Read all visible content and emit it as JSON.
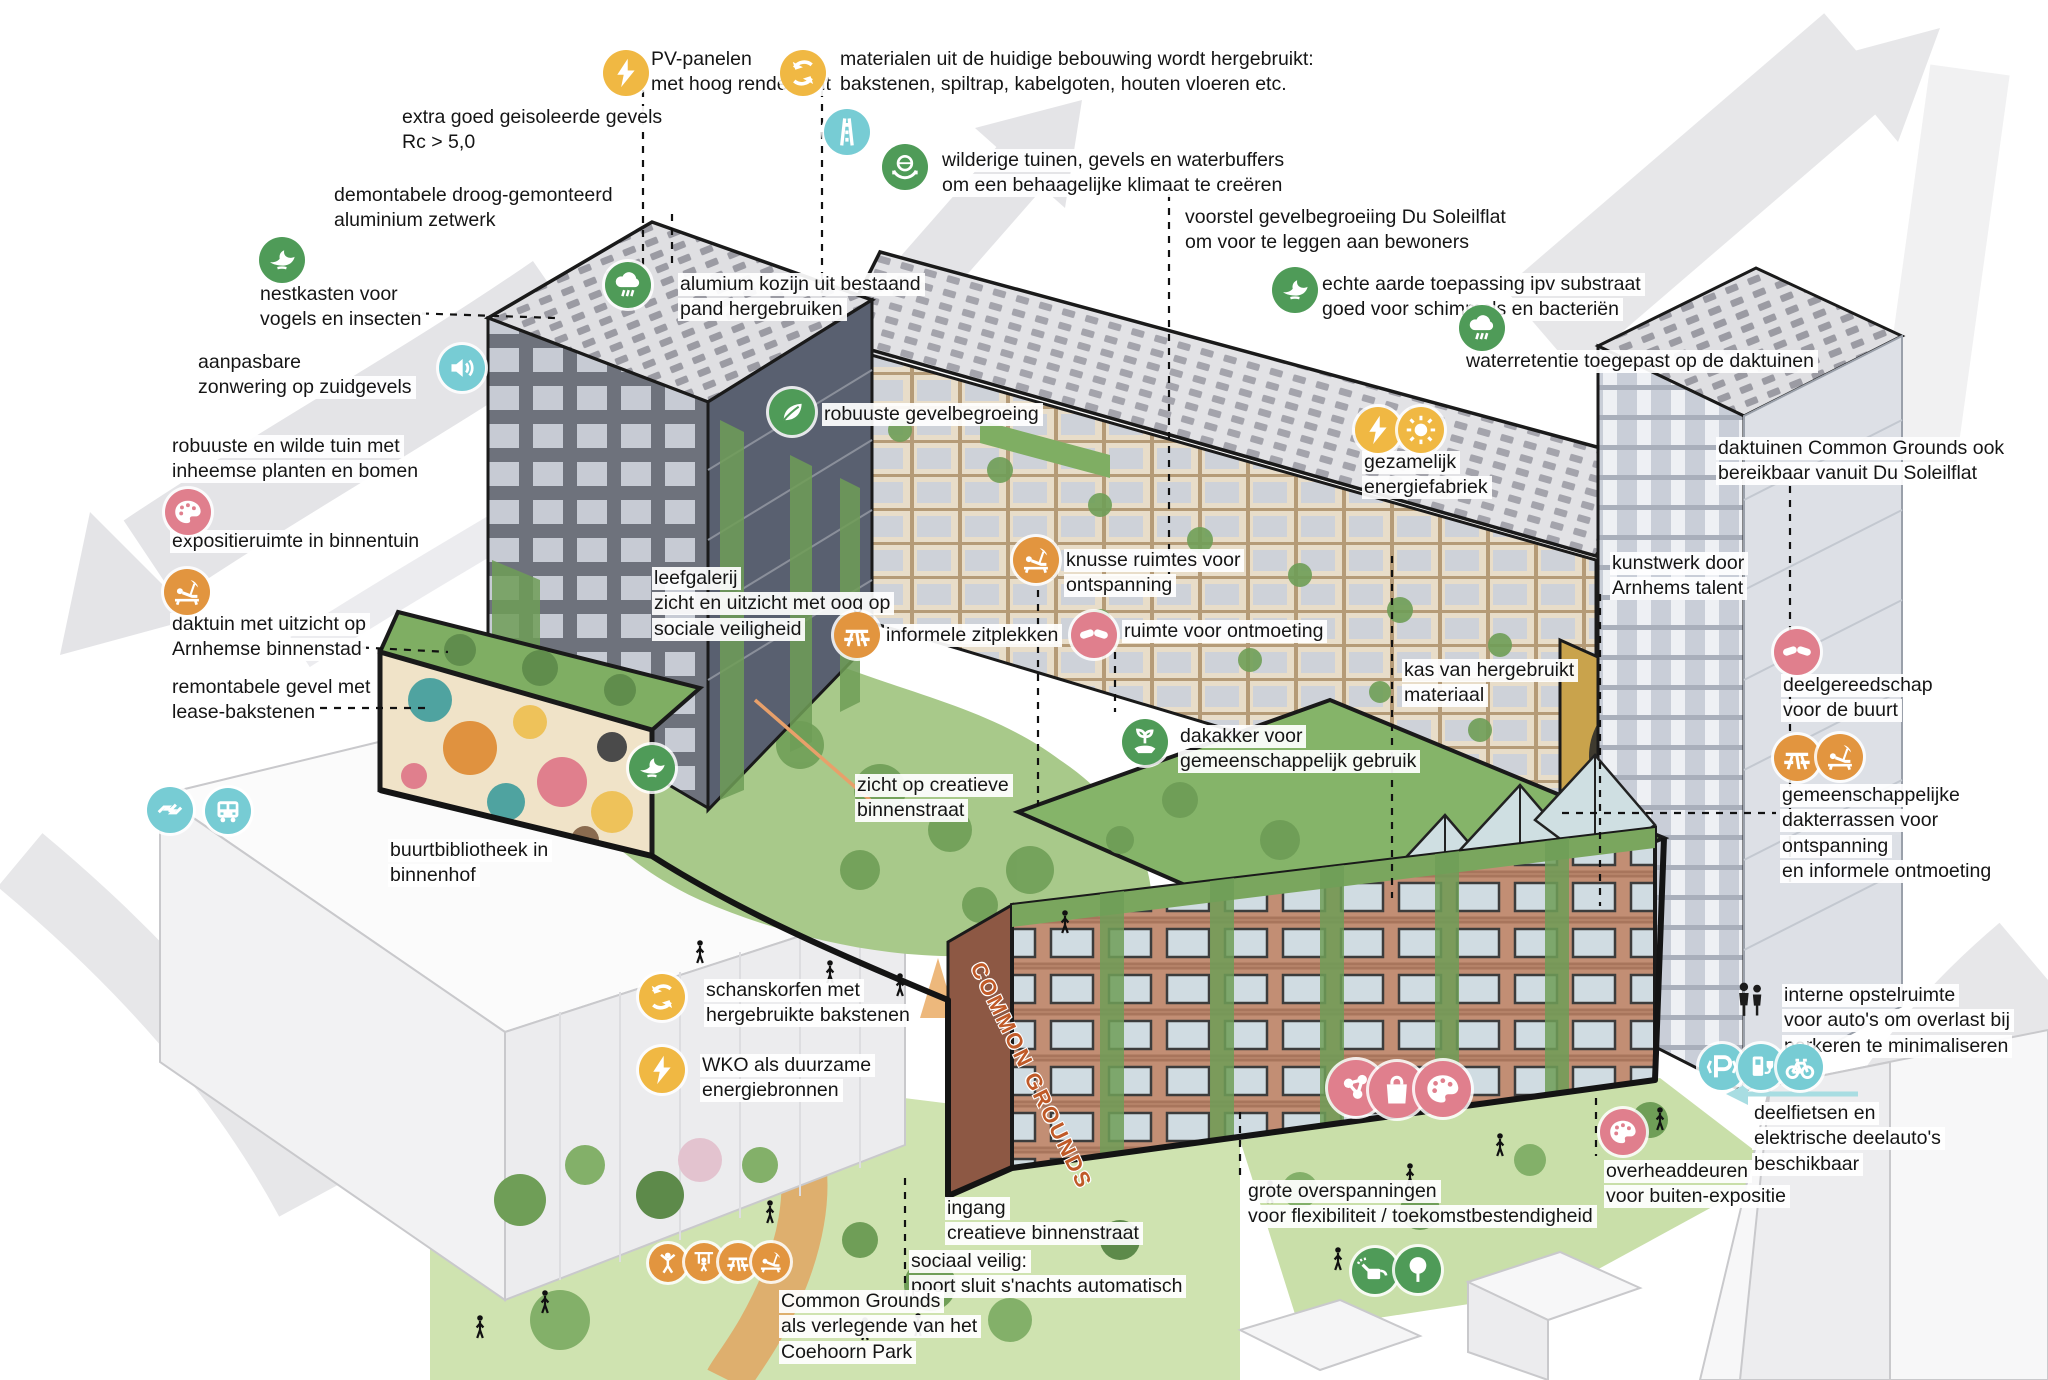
{
  "palette": {
    "yellow": "#f0b843",
    "teal": "#77ccd4",
    "green": "#4f9b58",
    "pink": "#e07f8d",
    "orange": "#e2953f",
    "plain": "none"
  },
  "sign": {
    "text": "COMMON GROUNDS"
  },
  "labels": [
    {
      "id": "pv-panelen",
      "x": 649,
      "y": 47,
      "text": "PV-panelen\nmet hoog rendement"
    },
    {
      "id": "extra-geisoleerd",
      "x": 400,
      "y": 105,
      "text": "extra goed geisoleerde gevels\nRc > 5,0"
    },
    {
      "id": "demontabele",
      "x": 332,
      "y": 183,
      "text": "demontabele droog-gemonteerd\naluminium zetwerk"
    },
    {
      "id": "materialen",
      "x": 838,
      "y": 47,
      "text": "materialen uit de huidige bebouwing wordt hergebruikt:\nbakstenen, spiltrap, kabelgoten, houten vloeren etc."
    },
    {
      "id": "wilderige-tuinen",
      "x": 940,
      "y": 148,
      "text": "wilderige tuinen, gevels en waterbuffers\nom een behaagelijke klimaat te creëren"
    },
    {
      "id": "nestkasten",
      "x": 258,
      "y": 282,
      "text": "nestkasten voor\nvogels en insecten"
    },
    {
      "id": "aanpasbare-zonwering",
      "x": 196,
      "y": 350,
      "text": "aanpasbare\nzonwering op zuidgevels"
    },
    {
      "id": "voorstel-gevelbegroeiing",
      "x": 1183,
      "y": 205,
      "text": "voorstel gevelbegroeiing Du Soleilflat\nom voor te leggen aan bewoners"
    },
    {
      "id": "echte-aarde",
      "x": 1320,
      "y": 272,
      "text": "echte aarde toepassing ipv substraat\ngoed voor schimmels en bacteriën"
    },
    {
      "id": "waterretentie",
      "x": 1464,
      "y": 349,
      "text": "waterretentie toegepast op de daktuinen"
    },
    {
      "id": "alumium-kozijn",
      "x": 678,
      "y": 272,
      "text": "alumium kozijn uit bestaand\npand hergebruiken"
    },
    {
      "id": "robuuste-tuin",
      "x": 170,
      "y": 434,
      "text": "robuuste en wilde tuin met\ninheemse planten en bomen"
    },
    {
      "id": "robuuste-gevelbegroeing",
      "x": 822,
      "y": 402,
      "text": "robuuste gevelbegroeing"
    },
    {
      "id": "expositieruimte",
      "x": 170,
      "y": 529,
      "text": "expositieruimte in binnentuin"
    },
    {
      "id": "daktuin-uitzicht",
      "x": 170,
      "y": 612,
      "text": "daktuin met uitzicht op\nArnhemse binnenstad"
    },
    {
      "id": "remontabele-gevel",
      "x": 170,
      "y": 675,
      "text": "remontabele gevel met\nlease-bakstenen"
    },
    {
      "id": "daktuinen-common-grounds",
      "x": 1716,
      "y": 436,
      "text": "daktuinen Common Grounds ook\nbereikbaar vanuit Du Soleilflat"
    },
    {
      "id": "gezamelijk-energiefabriek",
      "x": 1362,
      "y": 450,
      "text": "gezamelijk\nenergiefabriek"
    },
    {
      "id": "leefgalerij",
      "x": 652,
      "y": 566,
      "text": "leefgalerij\nzicht en uitzicht met oog op\nsociale veiligheid"
    },
    {
      "id": "knusse-ruimtes",
      "x": 1064,
      "y": 548,
      "text": "knusse ruimtes voor\nontspanning"
    },
    {
      "id": "kunstwerk",
      "x": 1610,
      "y": 551,
      "text": "kunstwerk door\nArnhems talent"
    },
    {
      "id": "informele-zitplekken",
      "x": 884,
      "y": 623,
      "text": "informele zitplekken"
    },
    {
      "id": "ruimte-ontmoeting",
      "x": 1122,
      "y": 619,
      "text": "ruimte voor ontmoeting"
    },
    {
      "id": "kas-hergebruikt",
      "x": 1402,
      "y": 658,
      "text": "kas van hergebruikt\nmateriaal"
    },
    {
      "id": "deelgereedschap",
      "x": 1781,
      "y": 673,
      "text": "deelgereedschap\nvoor de buurt"
    },
    {
      "id": "dakakker",
      "x": 1178,
      "y": 724,
      "text": "dakakker voor\ngemeenschappelijk gebruik"
    },
    {
      "id": "zicht-binnenstraat",
      "x": 855,
      "y": 773,
      "text": "zicht op creatieve\nbinnenstraat"
    },
    {
      "id": "gemeenschappelijke-dakterrassen",
      "x": 1780,
      "y": 783,
      "text": "gemeenschappelijke\ndakterrassen voor ontspanning\nen informele ontmoeting"
    },
    {
      "id": "buurtbibliotheek",
      "x": 388,
      "y": 838,
      "text": "buurtbibliotheek in\nbinnenhof"
    },
    {
      "id": "schanskorfen",
      "x": 704,
      "y": 978,
      "text": "schanskorfen met\nhergebruikte bakstenen"
    },
    {
      "id": "wko",
      "x": 700,
      "y": 1053,
      "text": "WKO als duurzame\nenergiebronnen"
    },
    {
      "id": "interne-opstelruimte",
      "x": 1782,
      "y": 983,
      "text": "interne opstelruimte\nvoor auto's om overlast bij\nparkeren te minimaliseren"
    },
    {
      "id": "deelfietsen",
      "x": 1752,
      "y": 1101,
      "text": "deelfietsen en\nelektrische deelauto's\nbeschikbaar"
    },
    {
      "id": "overheaddeuren",
      "x": 1604,
      "y": 1159,
      "text": "overheaddeuren\nvoor buiten-expositie"
    },
    {
      "id": "grote-overspanningen",
      "x": 1246,
      "y": 1179,
      "text": "grote overspanningen\nvoor flexibiliteit / toekomstbestendigheid"
    },
    {
      "id": "ingang-binnenstraat",
      "x": 945,
      "y": 1196,
      "text": "ingang\ncreatieve binnenstraat"
    },
    {
      "id": "sociaal-veilig",
      "x": 909,
      "y": 1249,
      "text": "sociaal veilig:\npoort sluit s'nachts automatisch"
    },
    {
      "id": "common-grounds-park",
      "x": 779,
      "y": 1289,
      "text": "Common Grounds\nals verlegende van het\nCoehoorn Park"
    }
  ],
  "icons": [
    {
      "name": "bolt-icon",
      "color": "yellow",
      "x": 626,
      "y": 73
    },
    {
      "name": "recycle-icon",
      "color": "yellow",
      "x": 803,
      "y": 73
    },
    {
      "name": "motorway-icon",
      "color": "teal",
      "x": 847,
      "y": 132
    },
    {
      "name": "hands-globe-icon",
      "color": "green",
      "x": 905,
      "y": 167
    },
    {
      "name": "dove-icon",
      "color": "green",
      "x": 282,
      "y": 260
    },
    {
      "name": "speaker-icon",
      "color": "teal",
      "x": 462,
      "y": 368
    },
    {
      "name": "dove-icon",
      "color": "green",
      "x": 1295,
      "y": 290
    },
    {
      "name": "raincloud-icon",
      "color": "green",
      "x": 1482,
      "y": 328
    },
    {
      "name": "raincloud-icon",
      "color": "green",
      "x": 628,
      "y": 285
    },
    {
      "name": "leaf-icon",
      "color": "green",
      "x": 792,
      "y": 412
    },
    {
      "name": "palette-icon",
      "color": "pink",
      "x": 188,
      "y": 512
    },
    {
      "name": "deckchair-icon",
      "color": "orange",
      "x": 187,
      "y": 592
    },
    {
      "name": "bolt-icon",
      "color": "yellow",
      "x": 1378,
      "y": 430
    },
    {
      "name": "sun-icon",
      "color": "yellow",
      "x": 1421,
      "y": 430
    },
    {
      "name": "deckchair-icon",
      "color": "orange",
      "x": 1036,
      "y": 560
    },
    {
      "name": "picnic-icon",
      "color": "orange",
      "x": 857,
      "y": 635
    },
    {
      "name": "handshake-icon",
      "color": "pink",
      "x": 1094,
      "y": 635
    },
    {
      "name": "sprout-icon",
      "color": "green",
      "x": 1145,
      "y": 742
    },
    {
      "name": "handshake-icon",
      "color": "pink",
      "x": 1797,
      "y": 652
    },
    {
      "name": "picnic-icon",
      "color": "orange",
      "x": 1797,
      "y": 758
    },
    {
      "name": "deckchair-icon",
      "color": "orange",
      "x": 1840,
      "y": 757
    },
    {
      "name": "dove-icon",
      "color": "green",
      "x": 652,
      "y": 768
    },
    {
      "name": "wave-icon",
      "color": "teal",
      "x": 170,
      "y": 810
    },
    {
      "name": "bus-icon",
      "color": "teal",
      "x": 228,
      "y": 811
    },
    {
      "name": "recycle-icon",
      "color": "yellow",
      "x": 662,
      "y": 997
    },
    {
      "name": "bolt-icon",
      "color": "yellow",
      "x": 662,
      "y": 1070
    },
    {
      "name": "people-icon",
      "color": "plain",
      "x": 1750,
      "y": 1000,
      "d": 54
    },
    {
      "name": "parking-icon",
      "color": "teal",
      "x": 1722,
      "y": 1067
    },
    {
      "name": "charger-icon",
      "color": "teal",
      "x": 1761,
      "y": 1067
    },
    {
      "name": "bike-icon",
      "color": "teal",
      "x": 1800,
      "y": 1067
    },
    {
      "name": "palette-icon",
      "color": "pink",
      "x": 1623,
      "y": 1132
    },
    {
      "name": "climb-icon",
      "color": "orange",
      "x": 668,
      "y": 1263,
      "d": 38
    },
    {
      "name": "swing-icon",
      "color": "orange",
      "x": 704,
      "y": 1262,
      "d": 38
    },
    {
      "name": "picnic-icon",
      "color": "orange",
      "x": 738,
      "y": 1262,
      "d": 38
    },
    {
      "name": "deckchair-icon",
      "color": "orange",
      "x": 771,
      "y": 1262,
      "d": 38
    },
    {
      "name": "molecule-icon",
      "color": "pink",
      "x": 1356,
      "y": 1088,
      "d": 56
    },
    {
      "name": "bag-icon",
      "color": "pink",
      "x": 1397,
      "y": 1090,
      "d": 56
    },
    {
      "name": "palette-icon",
      "color": "pink",
      "x": 1443,
      "y": 1089,
      "d": 56
    },
    {
      "name": "wateringcan-icon",
      "color": "green",
      "x": 1375,
      "y": 1271
    },
    {
      "name": "tree-icon",
      "color": "green",
      "x": 1418,
      "y": 1270
    }
  ]
}
